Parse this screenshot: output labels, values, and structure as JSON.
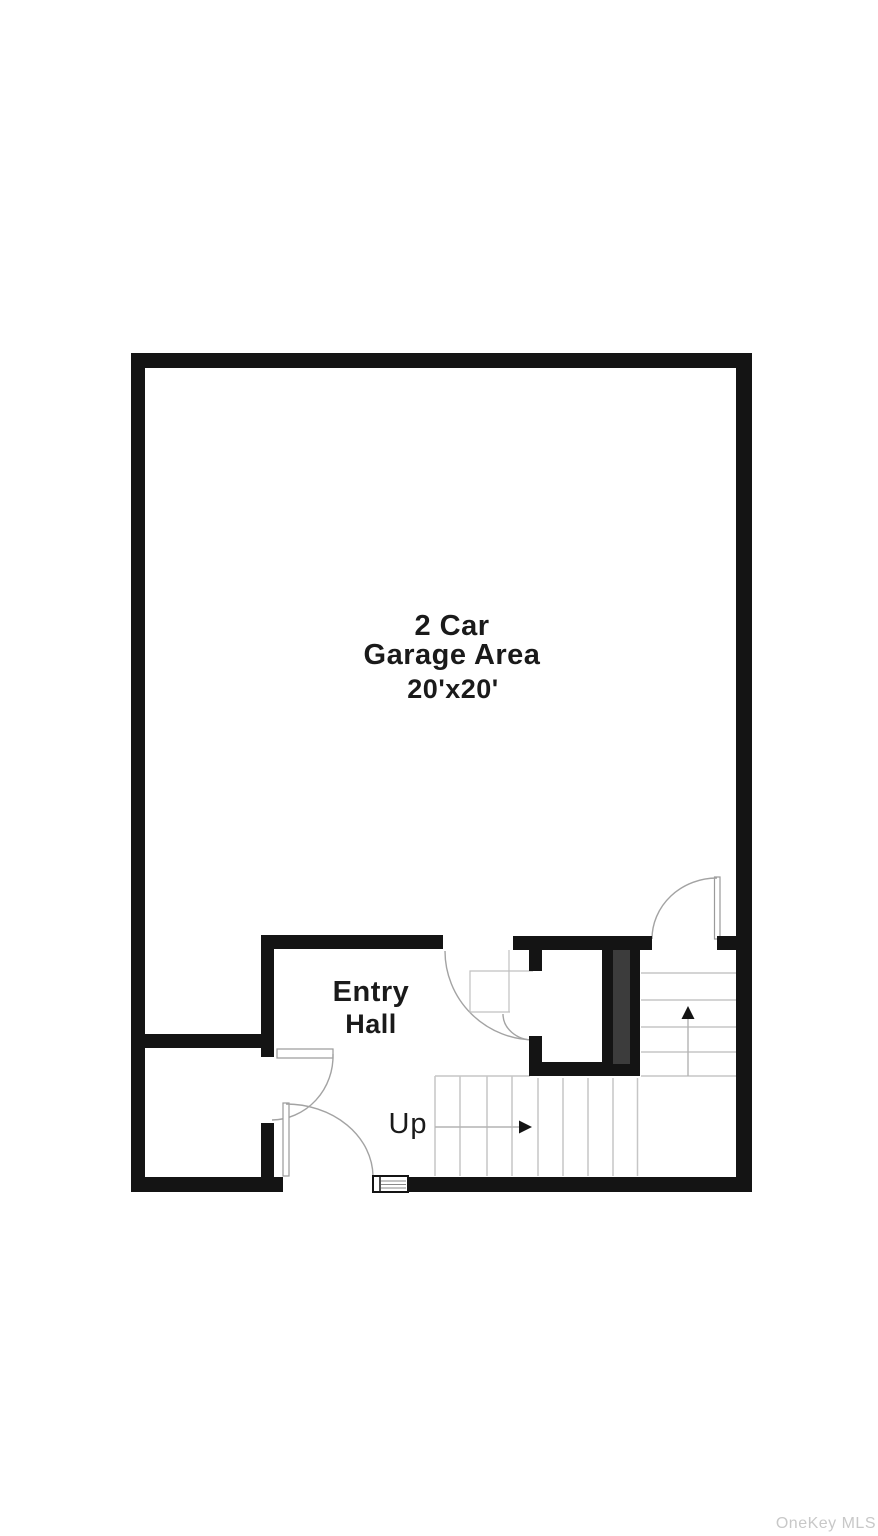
{
  "floorplan": {
    "labels": {
      "garage_line1": "2 Car",
      "garage_line2": "Garage Area",
      "garage_dims": "20'x20'",
      "entry_line1": "Entry",
      "entry_line2": "Hall",
      "stairs_direction": "Up"
    }
  },
  "watermark": "OneKey MLS",
  "colors": {
    "background": "#ffffff",
    "wall": "#141414",
    "duct_fill": "#3c3c3c",
    "stair_line": "#c6c6c6",
    "door_line": "#a3a3a3",
    "label_text": "#1a1a1a",
    "watermark_text": "#c8c8c8"
  }
}
